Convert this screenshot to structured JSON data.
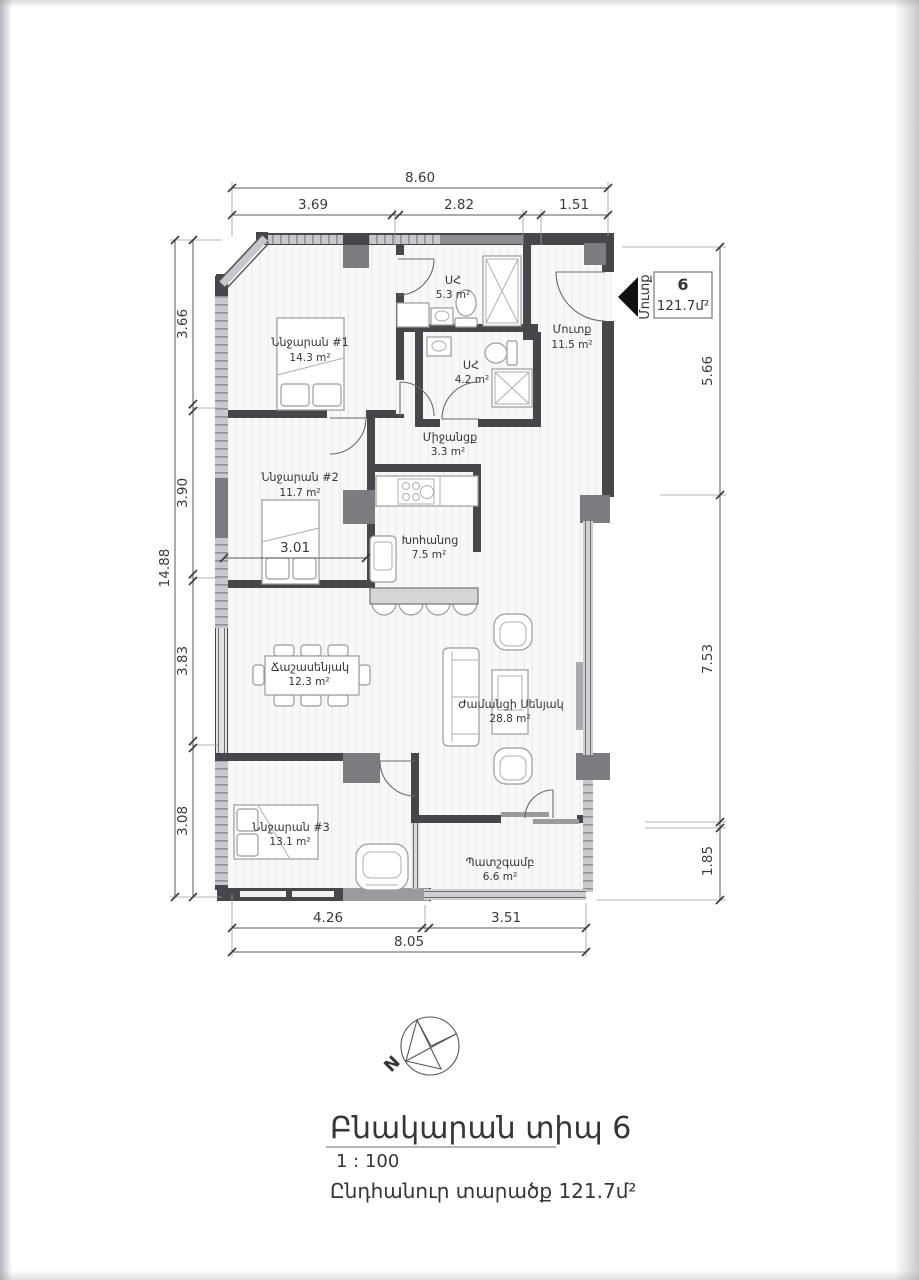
{
  "plan": {
    "unit": {
      "number": "6",
      "area": "121.7մ²",
      "entry_label": "Մուտք"
    },
    "rooms": [
      {
        "name": "Ննջարան #1",
        "area": "14.3 m²"
      },
      {
        "name": "ՍՀ",
        "area": "5.3 m²"
      },
      {
        "name": "Մուտք",
        "area": "11.5 m²"
      },
      {
        "name": "ՍՀ",
        "area": "4.2 m²"
      },
      {
        "name": "Միջանցք",
        "area": "3.3 m²"
      },
      {
        "name": "Ննջարան #2",
        "area": "11.7 m²"
      },
      {
        "name": "Խոհանոց",
        "area": "7.5 m²"
      },
      {
        "name": "Ճաշասենյակ",
        "area": "12.3 m²"
      },
      {
        "name": "Ժամանցի Սենյակ",
        "area": "28.8 m²"
      },
      {
        "name": "Ննջարան #3",
        "area": "13.1 m²"
      },
      {
        "name": "Պատշգամբ",
        "area": "6.6 m²"
      }
    ],
    "dims": {
      "top_total": "8.60",
      "top": [
        "3.69",
        "2.82",
        "1.51"
      ],
      "left_total": "14.88",
      "left": [
        "3.66",
        "3.90",
        "3.83",
        "3.08"
      ],
      "right": [
        "5.66",
        "7.53",
        "1.85"
      ],
      "bottom": [
        "4.26",
        "3.51"
      ],
      "bottom_total": "8.05",
      "inner": "3.01"
    },
    "compass_n": "N"
  },
  "title_block": {
    "title": "Բնակարան տիպ 6",
    "scale": "1 : 100",
    "total_area": "Ընդհանուր տարածք 121.7մ²"
  }
}
